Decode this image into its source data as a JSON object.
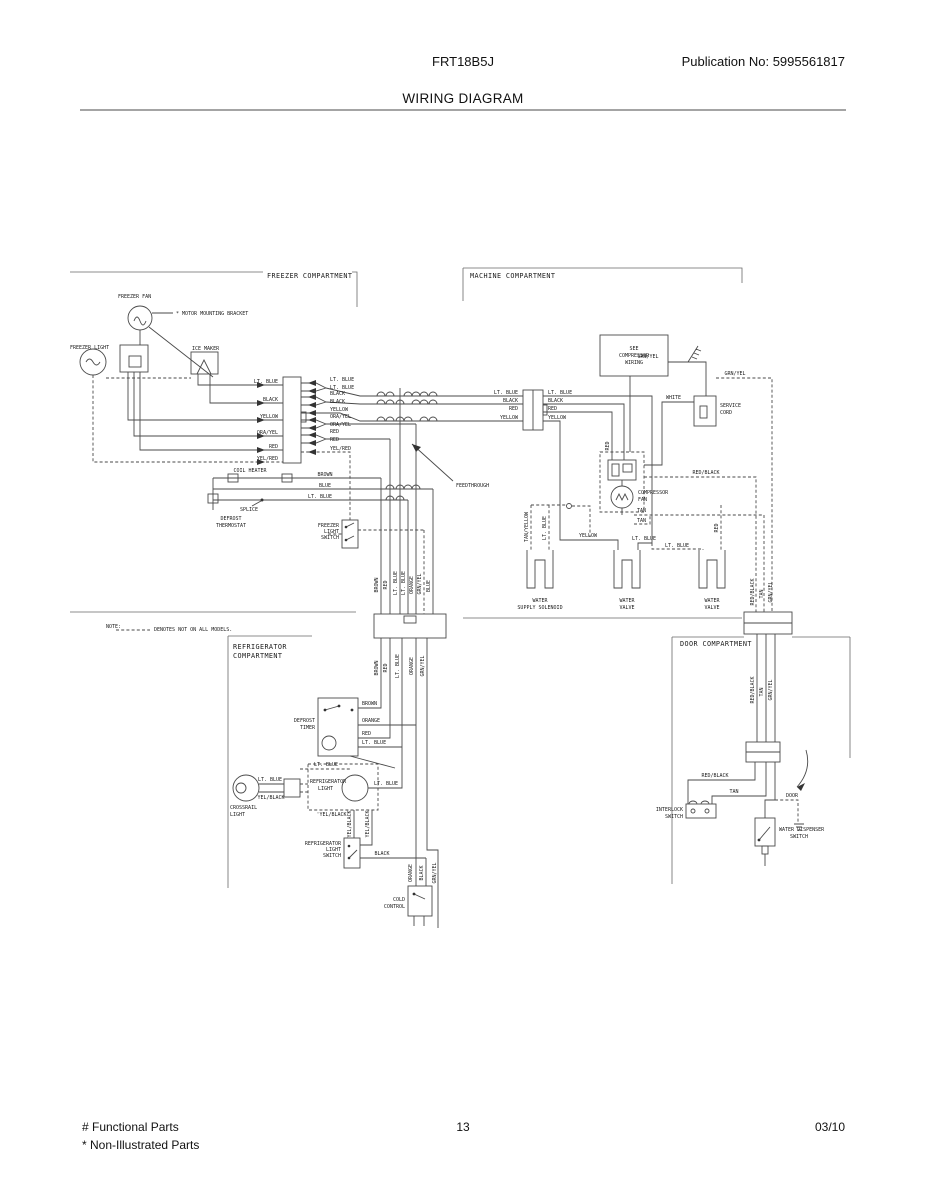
{
  "header": {
    "model": "FRT18B5J",
    "publication": "Publication No:  5995561817",
    "title": "WIRING DIAGRAM"
  },
  "footer": {
    "functional_parts": "# Functional Parts",
    "non_illustrated_parts": "* Non-Illustrated Parts",
    "page": "13",
    "date": "03/10"
  },
  "sections": {
    "freezer": "FREEZER COMPARTMENT",
    "machine": "MACHINE COMPARTMENT",
    "refrigerator": [
      "REFRIGERATOR",
      "COMPARTMENT"
    ],
    "door": "DOOR COMPARTMENT"
  },
  "note": {
    "label": "NOTE:",
    "text": "DENOTES NOT ON ALL MODELS."
  },
  "components": {
    "freezer_fan": "FREEZER FAN",
    "motor_mounting_bracket": "* MOTOR MOUNTING BRACKET",
    "freezer_light": "FREEZER LIGHT",
    "ice_maker": "ICE MAKER",
    "coil_heater": "COIL HEATER",
    "splice": "SPLICE",
    "defrost_thermostat": [
      "DEFROST",
      "THERMOSTAT"
    ],
    "freezer_light_switch": [
      "FREEZER",
      "LIGHT",
      "SWITCH"
    ],
    "feedthrough": "FEEDTHROUGH",
    "see_compressor_wiring": [
      "SEE",
      "COMPRESSOR",
      "WIRING"
    ],
    "service_cord": [
      "SERVICE",
      "CORD"
    ],
    "compressor_fan": [
      "COMPRESSOR",
      "FAN"
    ],
    "water_supply_solenoid": [
      "WATER",
      "SUPPLY SOLENOID"
    ],
    "water_valve_1": [
      "WATER",
      "VALVE"
    ],
    "water_valve_2": [
      "WATER",
      "VALVE"
    ],
    "defrost_timer": [
      "DEFROST",
      "TIMER"
    ],
    "crossrail_light": [
      "CROSSRAIL",
      "LIGHT"
    ],
    "refrigerator_light": [
      "REFRIGERATOR",
      "LIGHT"
    ],
    "refrigerator_light_switch": [
      "REFRIGERATOR",
      "LIGHT",
      "SWITCH"
    ],
    "cold_control": [
      "COLD",
      "CONTROL"
    ],
    "interlock_switch": [
      "INTERLOCK",
      "SWITCH"
    ],
    "water_dispenser_switch": [
      "WATER DISPENSER",
      "SWITCH"
    ],
    "door": "DOOR"
  },
  "wires": {
    "freezer_left": [
      "LT. BLUE",
      "BLACK",
      "YELLOW",
      "ORA/YEL",
      "RED",
      "YEL/RED"
    ],
    "freezer_right": [
      "LT. BLUE",
      "LT. BLUE",
      "BLACK",
      "BLACK",
      "YELLOW",
      "ORA/YEL",
      "ORA/YEL",
      "RED",
      "RED",
      "YEL/RED"
    ],
    "machine_left": [
      "LT. BLUE",
      "BLACK",
      "RED",
      "YELLOW"
    ],
    "machine_right": [
      "LT. BLUE",
      "BLACK",
      "RED",
      "YELLOW"
    ],
    "defrost_loop": [
      "BROWN",
      "BLUE",
      "LT. BLUE"
    ],
    "drops_top": [
      "BROWN",
      "RED",
      "LT. BLUE",
      "LT. BLUE",
      "ORANGE",
      "GRN/YEL",
      "BLUE"
    ],
    "drops_bottom": [
      "BROWN",
      "RED",
      "LT. BLUE",
      "ORANGE",
      "GRN/YEL"
    ],
    "timer": [
      "BROWN",
      "ORANGE",
      "RED",
      "LT. BLUE"
    ],
    "machine_misc": {
      "white": "WHITE",
      "grn_yel_ground": "GRN/YEL",
      "grn_yel_door": "GRN/YEL",
      "red_relay": "RED",
      "red_black": "RED/BLACK",
      "tan_a": "TAN",
      "tan_b": "TAN",
      "yellow_valve": "YELLOW",
      "lt_blue_valve": "LT. BLUE",
      "lt_blue_valve_dashed": "LT. BLUE",
      "tan_yellow": "TAN/YELLOW",
      "lt_blue_v1": "LT. BLUE",
      "red_v3": "RED"
    },
    "door_top": [
      "RED/BLACK",
      "TAN",
      "GRN/YEL"
    ],
    "door_mid": [
      "RED/BLACK",
      "TAN",
      "GRN/YEL"
    ],
    "door_lower": {
      "red_black": "RED/BLACK",
      "tan": "TAN"
    },
    "fridge": {
      "lt_blue_top": "LT. BLUE",
      "lt_blue_crossrail": "LT. BLUE",
      "yel_black_crossrail": "YEL/BLACK",
      "lt_blue_right": "LT. BLUE",
      "yel_black_quoted": "'YEL/BLACK'",
      "yel_black_v1": "YEL/BLACK",
      "yel_black_v2": "YEL/BLACK",
      "black_switch": "BLACK",
      "orange_cc": "ORANGE",
      "black_cc": "BLACK",
      "grn_yel_cc": "GRN/YEL"
    }
  }
}
